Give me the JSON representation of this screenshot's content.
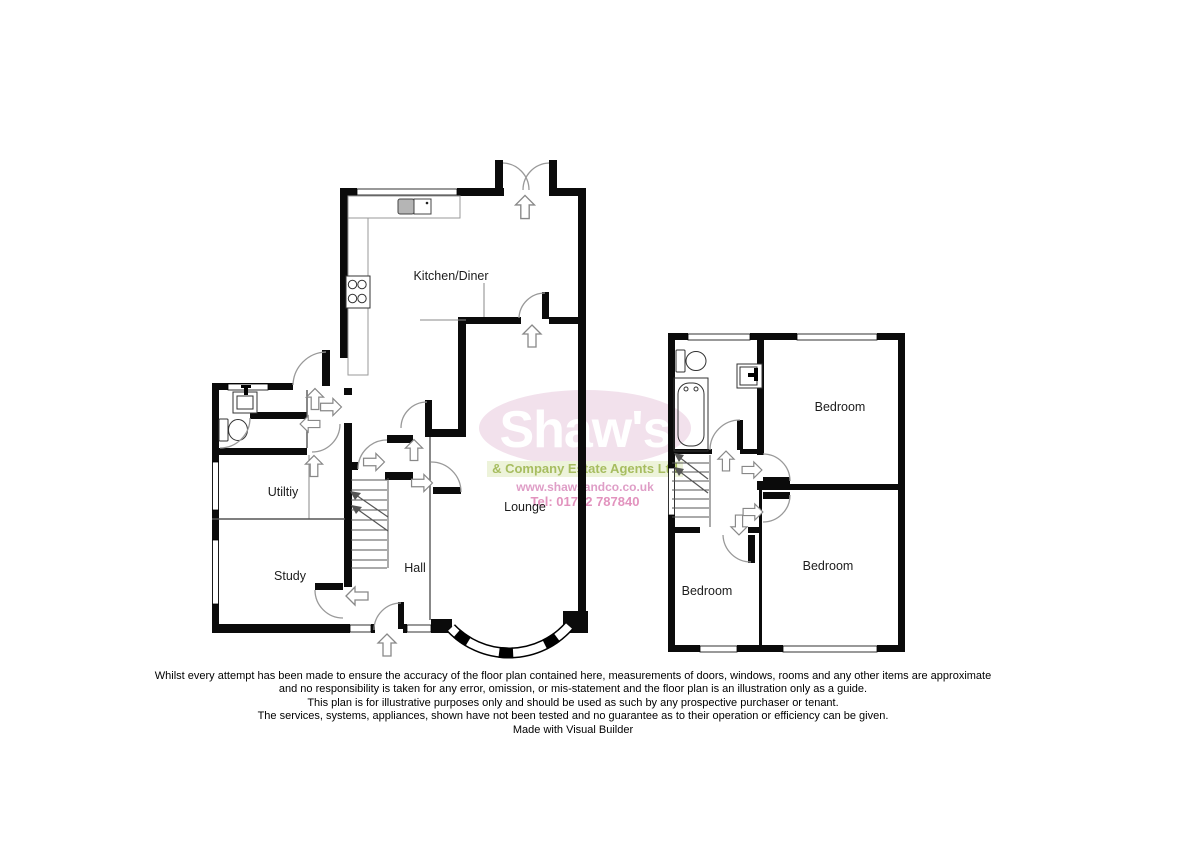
{
  "floorplan": {
    "ground_floor": {
      "kitchen_label": "Kitchen/Diner",
      "utility_label": "Utiltiy",
      "study_label": "Study",
      "hall_label": "Hall",
      "lounge_label": "Lounge"
    },
    "first_floor": {
      "bedroom_front_label": "Bedroom",
      "bedroom_rear_label": "Bedroom",
      "bedroom_small_label": "Bedroom"
    }
  },
  "watermark": {
    "brand": "Shaw's",
    "tagline": "& Company Estate Agents Ltd",
    "website": "www.shawsandco.co.uk",
    "phone": "Tel: 01782 787840",
    "colors": {
      "ellipse": "#f2e1ec",
      "brand_text": "#ffffff",
      "tagline_bg": "#edf3da",
      "tagline_text": "#a7bd60",
      "website_text": "#df9ec7",
      "phone_text": "#e293be"
    }
  },
  "disclaimer": {
    "line1": "Whilst every attempt has been made to ensure the accuracy of the floor plan contained here, measurements of doors, windows, rooms and any other items are approximate",
    "line2": "and no responsibility is taken for any error, omission, or mis-statement and the floor plan is an illustration only as a guide.",
    "line3": "This plan is for illustrative purposes only and should be used as such by any prospective purchaser or tenant.",
    "line4": "The services, systems, appliances, shown have not been tested and no guarantee  as to their operation or efficiency can be given.",
    "credit": "Made with Visual Builder"
  }
}
